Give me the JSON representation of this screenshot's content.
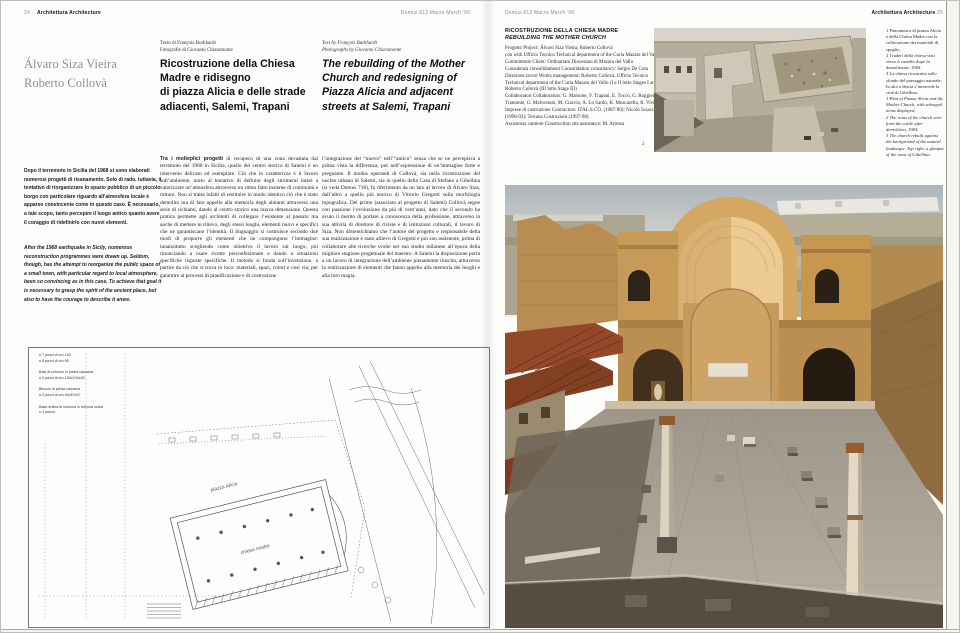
{
  "left_header": {
    "page_num": "24",
    "section": "Architettura Architecture",
    "issue": "Domus 812 Marzo March ’99"
  },
  "right_header": {
    "issue": "Domus 812 Marzo March ’99",
    "section": "Architettura Architecture",
    "page_num": "25"
  },
  "article": {
    "authors": "Álvaro Siza Vieira\nRoberto Collovà",
    "credits_it": "Testo di François Burkhardt\nFotografie di Giovanni Chiaramonte",
    "credits_en": "Text by François Burkhardt\nPhotographs by Giovanni Chiaramonte",
    "title_it": "Ricostruzione della Chiesa\nMadre e ridisegno\ndi piazza Alicia e delle strade\nadiacenti, Salemi, Trapani",
    "title_en": "The rebuilding of the Mother\nChurch and redesigning of\nPiazza Alicia and  adjacent\nstreets at Salemi, Trapani",
    "intro_it": "Dopo il terremoto in Sicilia del 1968 si sono elaborati numerosi progetti di risanamento. Solo di rado, tuttavia, il tentativo di riorganizzare lo spazio pubblico di un piccolo borgo con particolare riguardo all’atmosfera locale è apparso convincente come in questo caso. È necessario, a tale scopo, tanto percepire il luogo antico quanto avere il coraggio di ridefinirlo con nuovi elementi.",
    "intro_en": "After the 1968 earthquake in Sicily, numerous reconstruction programmes were drawn up. Seldom, though, has the attempt to reorganize the public space of a small town, with particular regard to local atmosphere, been so convincing as in this case. To achieve that goal it is necessary to grasp the spirit of the ancient place, but also to have the courage to describe it anew.",
    "body_col1_lead": "Tra i molteplici progetti",
    "body_col1_rest": " di recupero di una zona devastata dal terremoto del 1968 in Sicilia, quello del centro storico di Salemi è un intervento delicato ed esemplare. Ciò che lo caratterizza è il lavoro sull’ambiente, unito al tentativo di definire degli strumenti intesi a valorizzare un’atmosfera attraverso un ritmo fatto insieme di continuità e rotture. Non si tratta infatti di restituire in modo identico ciò che è stato demolito ma di fare appello alla memoria degli abitanti attraverso una serie di richiami, dando al centro storico una nuova dimensione. Questa pratica permette agli architetti di collegare l’esistente al passato ma anche di mettere in rilievo, degli stessi luoghi, elementi nuovi e specifici che ne garantiscano l’identità. Il linguaggio si costruisce secondo due modi di proporre gli elementi che ne compongono l’immagine: innanzitutto scegliendo come obiettivo il lavoro sul luogo; poi rinunciando a usare ricette preconfezionate e dando a situazioni specifiche risposte specifiche. Il metodo si fonda sull’invenzione, a partire da ciò che si trova in loco: materiali, spazi, colori e così via, per garantire ai processi di pianificazione e di costruzione",
    "body_col2": "l’integrazione del “nuovo” nell’“antico” senza che se ne percepisca a prima vista la differenza, pur nell’espressione di un’immagine forte e pregnante. Il modus operandi di Collovà, sia nella ricostruzione del nucleo urbano di Salemi, sia in quello della Casa di Stefano a Gibellina (si veda Domus 718), fa riferimento da un lato al lavoro di Álvaro Siza, dall’altro a quello più teorico di Vittorio Gregotti sulla morfologia topografica. Del primo (associato al progetto di Salemi) Collovà segue con passione l’evoluzione da più di vent’anni, dato che il secondo ha avuto il merito di portare a conoscenza della professione, attraverso la sua attività di direttore di riviste e di istituzioni culturali, il lavoro di Siza. Non dimentichiamo che l’autore del progetto e responsabile della sua realizzazione è stato allievo di Gregotti e poi suo assistente, prima di collaborare alle ricerche svolte nel suo studio milanese all’epoca della migliore stagione progettuale del maestro. A Salemi la disposizione porta a un lavoro di integrazione dell’ambiente pienamente riuscita, attraverso la realizzazione di elementi che fanno appello alla memoria dei luoghi e alla loro magia."
  },
  "plan": {
    "legend": "n.7 pezzi di cm 140\nn.5 pezzi di cm 90\n\nBasi di colonne in pietra calcarea\nn.2 pezzi di cm 130x100x30\n\nBlocchi di pietra calcarea\nn.2 pezzi di cm 90x67x67\n\nBase antica di colonna in breccia rossa\nn.1 pezzo",
    "label_piazza": "piazza Alicia",
    "label_chiesa": "chiesa madre"
  },
  "project": {
    "title_it": "RICOSTRUZIONE DELLA CHIESA MADRE",
    "title_en": "REBUILDING THE MOTHER CHURCH",
    "credits": "Progetto Project: Álvaro Siza Vieira, Roberto Collovà\ncon with Ufficio Tecnico Technical department of the Curia Mazara del Vallo\nCommittente Client: Ordinariato Diocesano di Mazara del Vallo\nConsulenza consolidamenti Consolidation consultancy: Sergio De Cola\nDirezione lavori Works management: Roberto Collovà, Ufficio Tecnico Technical department of the Curia Mazara del Vallo (I e II lotto Stages I and II); Roberto Collovà (III lotto Stage III)\nCollaboratori Collaborators: G. Marsone, V. Trapani, E. Tocco, G. Ruggieri, F. Tramonte, G. Malvestuto, M. Ciaccio, A. Lo Sardo, K. Muscarella, R. Viviano\nImprese di costruzione Contractors: ITAL.S.CO. (1987-90); Nicolò Sciacca (1990-92); Terrana Costruzioni (1997-98)\nAssistenza cantiere Construction site assistance: M. Arresta"
  },
  "figures": {
    "photo2_label": "2",
    "captions_it": "1 Panoramica di piazza Alicia e della Chiesa Madre con la collocazione dei materiali di spoglio.\n2 I ruderi della chiesa visti verso il castello dopo la demolizione, 1984.\n3 La chiesa ricostruita sullo sfondo del paesaggio naturale. In alto a destra s’intravede la città di Gibellina.",
    "captions_en": "1 Plan of Piazza Alicia and the Mother Church, with salvaged items displayed.\n2 The ruins of the church seen from the castle after demolition, 1984.\n3 The church rebuilt against the background of the natural landscape. Top right, a glimpse of the town of Gibellina."
  },
  "colors": {
    "stone_gold": "#c79a58",
    "vault_light": "#ecca92",
    "roof_red": "#94482a",
    "pavement_gray": "#aba294",
    "shadow": "#6e6557",
    "sky_haze": "#b4bcc2",
    "header_gray": "#8d8d8d"
  }
}
